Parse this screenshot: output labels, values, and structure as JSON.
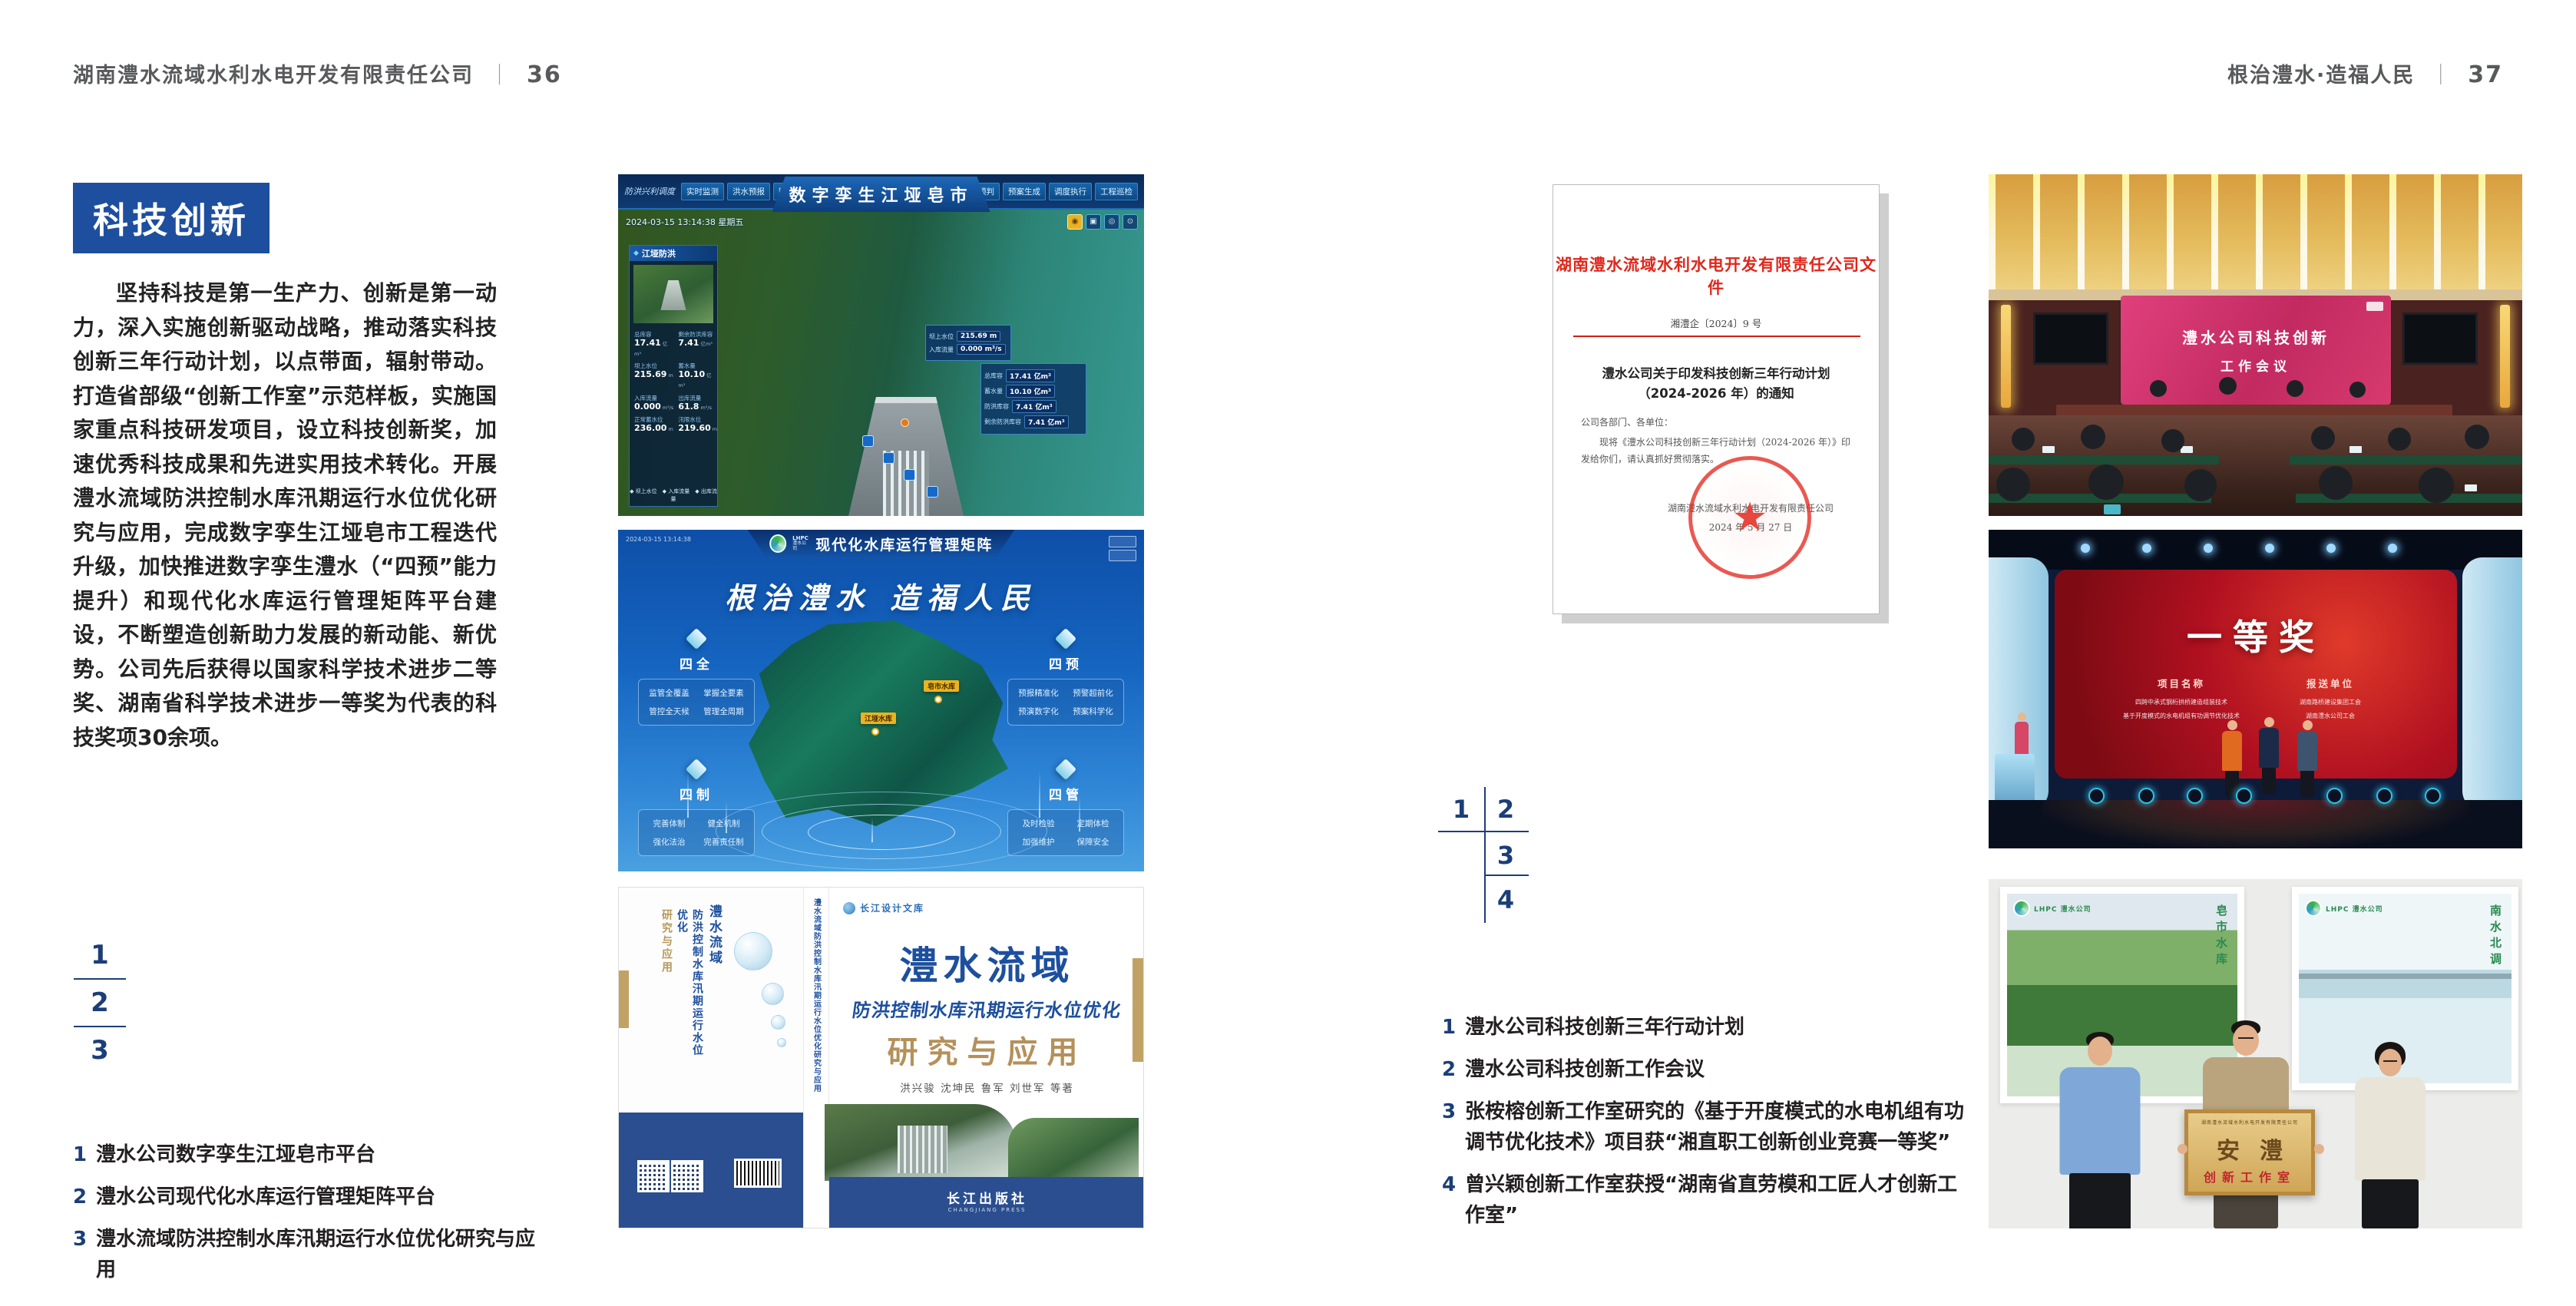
{
  "left_header": {
    "title": "湖南澧水流域水利水电开发有限责任公司",
    "separator": "｜",
    "page": "36"
  },
  "right_header": {
    "title": "根治澧水·造福人民",
    "separator": "｜",
    "page": "37"
  },
  "left_page": {
    "badge": "科技创新",
    "paragraph": "坚持科技是第一生产力、创新是第一动力，深入实施创新驱动战略，推动落实科技创新三年行动计划，以点带面，辐射带动。打造省部级“创新工作室”示范样板，实施国家重点科技研发项目，设立科技创新奖，加速优秀科技成果和先进实用技术转化。开展澧水流域防洪控制水库汛期运行水位优化研究与应用，完成数字孪生江垭皂市工程迭代升级，加快推进数字孪生澧水（“四预”能力提升）和现代化水库运行管理矩阵平台建设，不断塑造创新助力发展的新动能、新优势。公司先后获得以国家科学技术进步二等奖、湖南省科学技术进步一等奖为代表的科技奖项30余项。",
    "keys": [
      "1",
      "2",
      "3"
    ],
    "captions": [
      {
        "num": "1",
        "text": "澧水公司数字孪生江垭皂市平台"
      },
      {
        "num": "2",
        "text": "澧水公司现代化水库运行管理矩阵平台"
      },
      {
        "num": "3",
        "text": "澧水流域防洪控制水库汛期运行水位优化研究与应用"
      }
    ]
  },
  "right_page": {
    "keys": [
      "1",
      "2",
      "3",
      "4"
    ],
    "captions": [
      {
        "num": "1",
        "text": "澧水公司科技创新三年行动计划"
      },
      {
        "num": "2",
        "text": "澧水公司科技创新工作会议"
      },
      {
        "num": "3",
        "text": "张桉榕创新工作室研究的《基于开度模式的水电机组有功调节优化技术》项目获“湘直职工创新创业竞赛一等奖”"
      },
      {
        "num": "4",
        "text": "曾兴颖创新工作室获授“湖南省直劳模和工匠人才创新工作室”"
      }
    ]
  },
  "dashboard": {
    "title": "数字孪生江垭皂市",
    "module_label": "防洪兴利调度",
    "left_tabs": [
      "实时监测",
      "洪水预报",
      "防洪预警"
    ],
    "right_tabs": [
      "风险预判",
      "预案生成",
      "调度执行",
      "工程巡检"
    ],
    "timestamp": "2024-03-15 13:14:38 星期五",
    "panel_title": "江垭防洪",
    "stats": [
      {
        "label": "总库容",
        "value": "17.41",
        "unit": "亿m³"
      },
      {
        "label": "剩余防洪库容",
        "value": "7.41",
        "unit": "亿m³"
      },
      {
        "label": "坝上水位",
        "value": "215.69",
        "unit": "m"
      },
      {
        "label": "蓄水量",
        "value": "10.10",
        "unit": "亿m³"
      },
      {
        "label": "入库流量",
        "value": "0.000",
        "unit": "m³/s"
      },
      {
        "label": "出库流量",
        "value": "61.8",
        "unit": "m³/s"
      },
      {
        "label": "正常蓄水位",
        "value": "236.00",
        "unit": "m"
      },
      {
        "label": "汛限水位",
        "value": "219.60",
        "unit": "m"
      }
    ],
    "legend": "◆ 坝上水位　◆ 入库流量　◆ 出库流量",
    "float_panel_a": [
      {
        "label": "坝上水位",
        "value": "215.69 m"
      },
      {
        "label": "入库流量",
        "value": "0.000 m³/s"
      }
    ],
    "float_panel_b": [
      {
        "label": "总库容",
        "value": "17.41 亿m³"
      },
      {
        "label": "蓄水量",
        "value": "10.10 亿m³"
      },
      {
        "label": "防洪库容",
        "value": "7.41 亿m³"
      },
      {
        "label": "剩余防洪库容",
        "value": "7.41 亿m³"
      }
    ]
  },
  "matrix": {
    "logo_line1": "LHPC",
    "logo_line2": "澧水公司",
    "header_title": "现代化水库运行管理矩阵",
    "slogan": "根治澧水  造福人民",
    "panels": [
      {
        "title": "四全",
        "items": [
          "监管全覆盖",
          "掌握全要素",
          "管控全天候",
          "管理全周期"
        ]
      },
      {
        "title": "四预",
        "items": [
          "预报精准化",
          "预警超前化",
          "预演数字化",
          "预案科学化"
        ]
      },
      {
        "title": "四制",
        "items": [
          "完善体制",
          "健全机制",
          "强化法治",
          "完善责任制"
        ]
      },
      {
        "title": "四管",
        "items": [
          "及时检验",
          "定期体检",
          "加强维护",
          "保障安全"
        ]
      }
    ],
    "map_tags": [
      "皂市水库",
      "江垭水库"
    ]
  },
  "book": {
    "series": "长江设计文库",
    "title_main": "澧水流域",
    "title_sub": "防洪控制水库汛期运行水位优化",
    "title_tail": "研究与应用",
    "authors": "洪兴骏  沈坤民  鲁军  刘世军  等著",
    "spine_text": "澧水流域防洪控制水库汛期运行水位优化研究与应用",
    "publisher": "长江出版社",
    "publisher_en": "CHANGJIANG PRESS"
  },
  "meeting": {
    "screen_line1": "澧水公司科技创新",
    "screen_line2": "工作会议"
  },
  "stage": {
    "award": "一等奖",
    "col1_header": "项目名称",
    "col2_header": "报送单位",
    "col1_items": [
      "四跨中承式钢桁拱桥建造组装技术",
      "基于开度模式的水电机组有功调节优化技术"
    ],
    "col2_items": [
      "湖南路桥建设集团工会",
      "湖南澧水公司工会"
    ]
  },
  "group_photo": {
    "poster_left_logo": "LHPC 澧水公司",
    "poster_left_caption": "皂市水库",
    "poster_right_logo": "LHPC 澧水公司",
    "poster_right_caption": "南水北调",
    "plaque_header": "湖南澧水流域水利水电开发有限责任公司",
    "plaque_title": "安澧",
    "plaque_sub": "创新工作室"
  },
  "document": {
    "red_title": "湖南澧水流域水利水电开发有限责任公司文件",
    "doc_number": "湘澧企〔2024〕9 号",
    "black_title_line1": "澧水公司关于印发科技创新三年行动计划",
    "black_title_line2": "（2024-2026 年）的通知",
    "salutation": "公司各部门、各单位：",
    "body_line1": "现将《澧水公司科技创新三年行动计划（2024-2026 年）》印",
    "body_line2": "发给你们，请认真抓好贯彻落实。",
    "signature": "湖南澧水流域水利水电开发有限责任公司",
    "date": "2024 年 5 月 27 日",
    "seal_star": "★"
  }
}
